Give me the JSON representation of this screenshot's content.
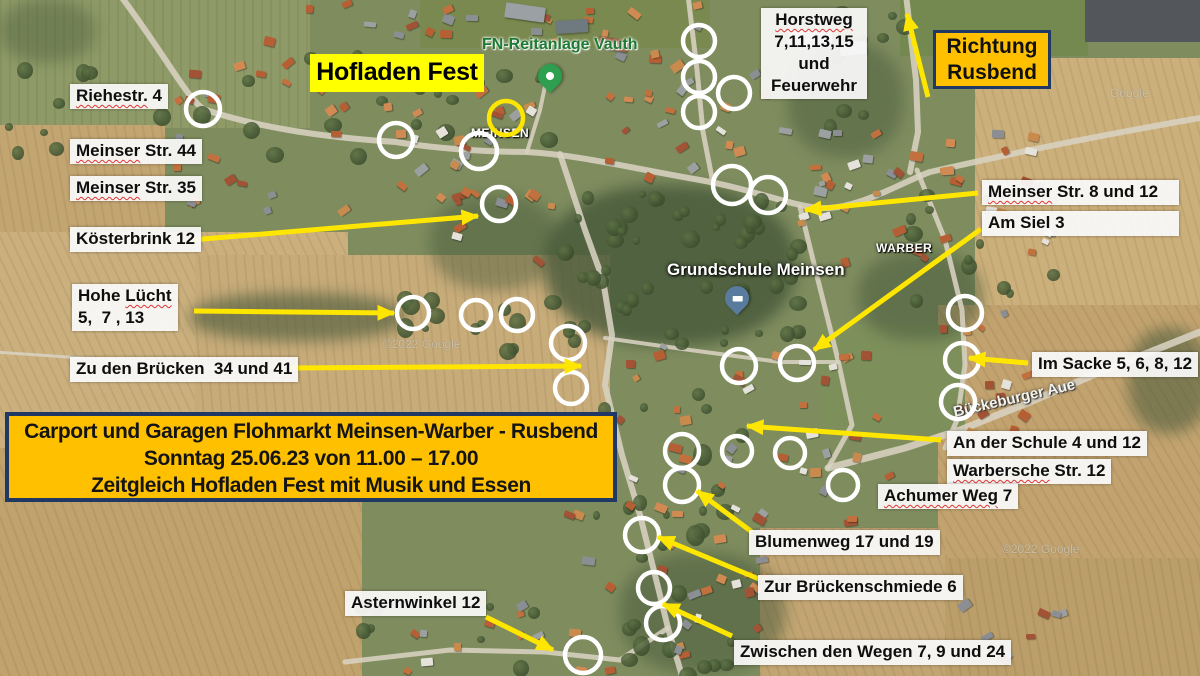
{
  "colors": {
    "arrow_yellow": "#ffe600",
    "circle_white": "#ffffff",
    "circle_yellow": "#ffe600",
    "callout_orange": "#ffc000",
    "callout_border_navy": "#203864",
    "banner_yellow": "#ffff00",
    "poi_green": "#1d7a35"
  },
  "title_banner": {
    "text": "Hofladen Fest"
  },
  "direction_box": {
    "line1": "Richtung",
    "line2": "Rusbend"
  },
  "event_box": {
    "line1": "Carport und Garagen Flohmarkt Meinsen-Warber - Rusbend",
    "line2": "Sonntag 25.06.23 von 11.00 – 17.00",
    "line3": "Zeitgleich Hofladen Fest mit Musik und Essen"
  },
  "street_labels": [
    {
      "id": "riehestr",
      "x": 70,
      "y": 84,
      "lines": [
        [
          {
            "t": "Riehestr.",
            "sq": true
          },
          {
            "t": " 4"
          }
        ]
      ]
    },
    {
      "id": "meinser-str-44",
      "x": 70,
      "y": 139,
      "lines": [
        [
          {
            "t": "Meinser",
            "sq": true
          },
          {
            "t": " Str. 44"
          }
        ]
      ]
    },
    {
      "id": "meinser-str-35",
      "x": 70,
      "y": 176,
      "lines": [
        [
          {
            "t": "Meinser",
            "sq": true
          },
          {
            "t": " Str. 35"
          }
        ]
      ]
    },
    {
      "id": "koesterbrink-12",
      "x": 70,
      "y": 227,
      "lines": [
        [
          {
            "t": "Kösterbrink 12"
          }
        ]
      ]
    },
    {
      "id": "hohe-luecht",
      "x": 72,
      "y": 284,
      "lines": [
        [
          {
            "t": "Hohe "
          },
          {
            "t": "Lücht",
            "sq": true
          }
        ],
        [
          {
            "t": "5,  7 , 13"
          }
        ]
      ]
    },
    {
      "id": "zu-den-bruecken",
      "x": 70,
      "y": 357,
      "lines": [
        [
          {
            "t": "Zu den Brücken  34 und 41"
          }
        ]
      ]
    },
    {
      "id": "horstweg",
      "x": 761,
      "y": 8,
      "w": 106,
      "center": true,
      "lines": [
        [
          {
            "t": "Horstweg",
            "sq": true
          }
        ],
        [
          {
            "t": "7,11,13,15"
          }
        ],
        [
          {
            "t": "und"
          }
        ],
        [
          {
            "t": "Feuerwehr"
          }
        ]
      ]
    },
    {
      "id": "meinser-str-8-12",
      "x": 982,
      "y": 180,
      "w": 197,
      "lines": [
        [
          {
            "t": "Meinser",
            "sq": true
          },
          {
            "t": " Str. 8 und 12"
          }
        ]
      ]
    },
    {
      "id": "am-siel-3",
      "x": 982,
      "y": 211,
      "w": 197,
      "lines": [
        [
          {
            "t": "Am Siel 3"
          }
        ]
      ]
    },
    {
      "id": "im-sacke",
      "x": 1032,
      "y": 352,
      "lines": [
        [
          {
            "t": "Im Sacke 5, 6, 8, 12"
          }
        ]
      ]
    },
    {
      "id": "an-der-schule",
      "x": 947,
      "y": 431,
      "lines": [
        [
          {
            "t": "An der Schule 4 und 12"
          }
        ]
      ]
    },
    {
      "id": "warbersche-str-12",
      "x": 947,
      "y": 459,
      "lines": [
        [
          {
            "t": "Warbersche",
            "sq": true
          },
          {
            "t": " Str. 12"
          }
        ]
      ]
    },
    {
      "id": "achumer-weg-7",
      "x": 878,
      "y": 484,
      "lines": [
        [
          {
            "t": "Achumer Weg",
            "sq": true
          },
          {
            "t": " 7"
          }
        ]
      ]
    },
    {
      "id": "blumenweg",
      "x": 749,
      "y": 530,
      "lines": [
        [
          {
            "t": "Blumenweg 17 und 19"
          }
        ]
      ]
    },
    {
      "id": "zur-brueckenschmiede",
      "x": 758,
      "y": 575,
      "lines": [
        [
          {
            "t": "Zur Brückenschmiede 6"
          }
        ]
      ]
    },
    {
      "id": "zwischen-den-wegen",
      "x": 734,
      "y": 640,
      "lines": [
        [
          {
            "t": "Zwischen den Wegen 7, 9 und 24"
          }
        ]
      ]
    },
    {
      "id": "asternwinkel-12",
      "x": 345,
      "y": 591,
      "lines": [
        [
          {
            "t": "Asternwinkel 12"
          }
        ]
      ]
    }
  ],
  "map_poi": [
    {
      "id": "fn-reitanlage-vauth",
      "text": "FN-Reitanlage Vauth",
      "x": 482,
      "y": 36,
      "cls": "poi-green"
    },
    {
      "id": "meinsen-place",
      "text": "MEINSEN",
      "x": 471,
      "y": 126,
      "cls": "poi-white-sm"
    },
    {
      "id": "warber-place",
      "text": "WARBER",
      "x": 876,
      "y": 241,
      "cls": "poi-white-sm"
    },
    {
      "id": "grundschule-meinsen",
      "text": "Grundschule Meinsen",
      "x": 667,
      "y": 260,
      "cls": "poi-white-lg"
    },
    {
      "id": "bueckeburger-aue",
      "text": "Bückeburger Aue",
      "x": 952,
      "y": 390,
      "cls": "poi-aue"
    },
    {
      "id": "watermark-1",
      "text": "©2022 Google",
      "x": 383,
      "y": 337,
      "cls": "poi-wm"
    },
    {
      "id": "watermark-2",
      "text": "Google",
      "x": 1110,
      "y": 86,
      "cls": "poi-wm"
    },
    {
      "id": "watermark-3",
      "text": "©2022 Google",
      "x": 1002,
      "y": 542,
      "cls": "poi-wm"
    }
  ],
  "pins": [
    {
      "id": "fn-reitanlage-pin",
      "type": "green",
      "x": 550,
      "y": 90
    },
    {
      "id": "grundschule-pin",
      "type": "school",
      "x": 737,
      "y": 312
    }
  ],
  "circles": [
    {
      "x": 203,
      "y": 109,
      "r": 17
    },
    {
      "x": 396,
      "y": 140,
      "r": 17
    },
    {
      "x": 479,
      "y": 151,
      "r": 18
    },
    {
      "x": 499,
      "y": 204,
      "r": 17
    },
    {
      "x": 506,
      "y": 118,
      "r": 17,
      "c": "yellow"
    },
    {
      "x": 699,
      "y": 41,
      "r": 16
    },
    {
      "x": 699,
      "y": 77,
      "r": 16
    },
    {
      "x": 699,
      "y": 112,
      "r": 16
    },
    {
      "x": 734,
      "y": 93,
      "r": 16
    },
    {
      "x": 732,
      "y": 185,
      "r": 19
    },
    {
      "x": 768,
      "y": 195,
      "r": 18
    },
    {
      "x": 413,
      "y": 313,
      "r": 16
    },
    {
      "x": 476,
      "y": 315,
      "r": 15
    },
    {
      "x": 517,
      "y": 315,
      "r": 16
    },
    {
      "x": 568,
      "y": 343,
      "r": 17
    },
    {
      "x": 571,
      "y": 388,
      "r": 16
    },
    {
      "x": 965,
      "y": 313,
      "r": 17
    },
    {
      "x": 962,
      "y": 360,
      "r": 17
    },
    {
      "x": 958,
      "y": 402,
      "r": 17
    },
    {
      "x": 739,
      "y": 366,
      "r": 17
    },
    {
      "x": 797,
      "y": 363,
      "r": 17
    },
    {
      "x": 682,
      "y": 451,
      "r": 17
    },
    {
      "x": 737,
      "y": 451,
      "r": 15
    },
    {
      "x": 790,
      "y": 453,
      "r": 15
    },
    {
      "x": 682,
      "y": 485,
      "r": 17
    },
    {
      "x": 843,
      "y": 485,
      "r": 15
    },
    {
      "x": 642,
      "y": 535,
      "r": 17
    },
    {
      "x": 654,
      "y": 588,
      "r": 16
    },
    {
      "x": 663,
      "y": 623,
      "r": 17
    },
    {
      "x": 583,
      "y": 655,
      "r": 18
    }
  ],
  "arrows": [
    {
      "id": "arrow-koesterbrink",
      "x1": 191,
      "y1": 240,
      "x2": 478,
      "y2": 216
    },
    {
      "id": "arrow-hohe-luecht",
      "x1": 194,
      "y1": 311,
      "x2": 394,
      "y2": 313
    },
    {
      "id": "arrow-zu-den-bruecken",
      "x1": 287,
      "y1": 368,
      "x2": 581,
      "y2": 366
    },
    {
      "id": "arrow-richtung-rusbend",
      "x1": 928,
      "y1": 97,
      "x2": 907,
      "y2": 14
    },
    {
      "id": "arrow-meinser-8-12",
      "x1": 978,
      "y1": 193,
      "x2": 805,
      "y2": 210
    },
    {
      "id": "arrow-am-siel",
      "x1": 981,
      "y1": 229,
      "x2": 814,
      "y2": 350
    },
    {
      "id": "arrow-im-sacke",
      "x1": 1028,
      "y1": 363,
      "x2": 969,
      "y2": 358
    },
    {
      "id": "arrow-an-der-schule",
      "x1": 941,
      "y1": 440,
      "x2": 747,
      "y2": 426
    },
    {
      "id": "arrow-blumenweg",
      "x1": 752,
      "y1": 532,
      "x2": 697,
      "y2": 491
    },
    {
      "id": "arrow-zur-brueckenschmiede",
      "x1": 759,
      "y1": 579,
      "x2": 658,
      "y2": 537
    },
    {
      "id": "arrow-zwischen-den-wegen",
      "x1": 732,
      "y1": 636,
      "x2": 663,
      "y2": 604
    },
    {
      "id": "arrow-asternwinkel",
      "x1": 486,
      "y1": 617,
      "x2": 553,
      "y2": 650
    }
  ]
}
